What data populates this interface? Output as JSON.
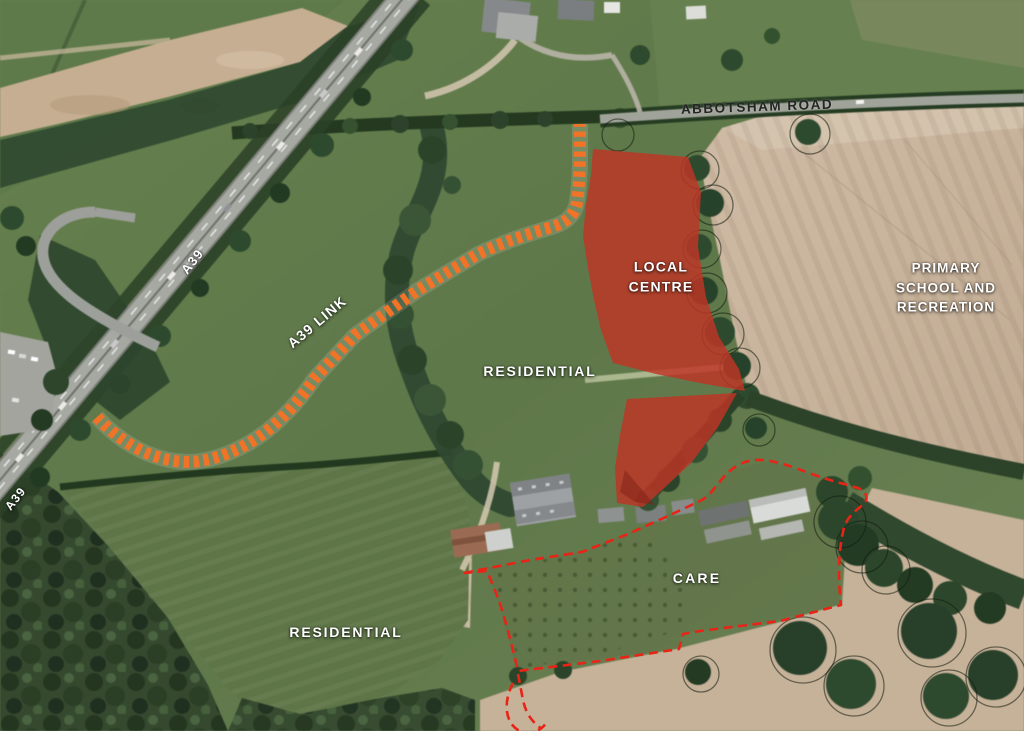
{
  "map": {
    "description": "Aerial masterplan of development site",
    "road_labels": {
      "abbotsham_road": "ABBOTSHAM ROAD",
      "a39": "A39",
      "a39_secondary": "A39",
      "a39_link": "A39 LINK"
    },
    "zone_labels": {
      "local_centre": "LOCAL CENTRE",
      "primary_school": "PRIMARY SCHOOL AND RECREATION",
      "residential_north": "RESIDENTIAL",
      "residential_south": "RESIDENTIAL",
      "care": "CARE"
    },
    "colors": {
      "local_centre_fill": "#c03426",
      "proposed_link_dash": "#f07327",
      "site_boundary_dash": "#e82417",
      "zone_label_text": "#ffffff",
      "road_label_text": "#242424"
    }
  }
}
